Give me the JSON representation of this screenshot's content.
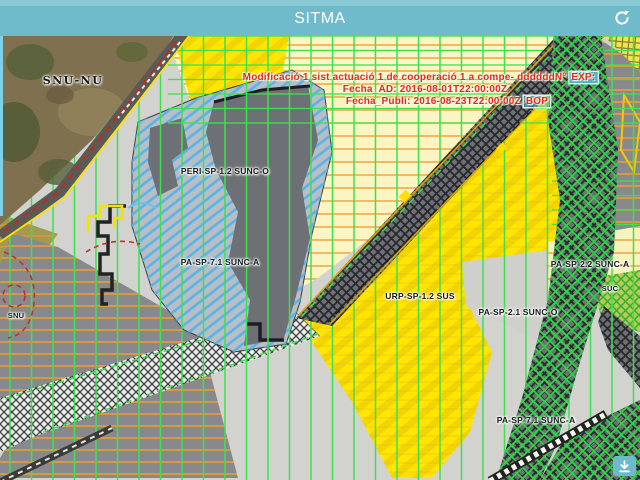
{
  "app": {
    "title": "SITMA",
    "header_color": "#6fbacb",
    "icons": {
      "refresh": "circular-refresh-arrow",
      "download": "download-arrow"
    }
  },
  "map": {
    "annotation": {
      "line1": "Modificació 1 sist actuació 1 de cooperació 1 a compe- ddddddNº",
      "line1_badge": "EXP:",
      "line2": "Fecha_AD: 2016-08-01T22:00:00Z",
      "line3": "Fecha_Publi: 2016-08-23T22:00:00Z",
      "line3_badge": "BOP",
      "text_color": "#dd2a1f",
      "badge_bg": "#4fb0c3"
    },
    "labels": [
      {
        "text": "SNU-NU"
      },
      {
        "text": "PERI-SP-1.2 SUNC-O"
      },
      {
        "text": "PA-SP-7.1 SUNC-A"
      },
      {
        "text": "URP-SP-1.2 SUS"
      },
      {
        "text": "PA-SP-2.1 SUNC-O"
      },
      {
        "text": "PA-SP-2.2 SUNC-A"
      },
      {
        "text": "SUC"
      },
      {
        "text": "PA-SP-7.1 SUNC-A"
      },
      {
        "text": "SNU"
      }
    ],
    "colors": {
      "grid_green": "#3ce24d",
      "zone_yellow": "#ffe600",
      "zone_pale_yellow": "#faf5c2",
      "zone_blue_hatch": "#57b4e8",
      "zone_light_gray": "#d2d2cf",
      "zone_dark_gray": "#6d7074",
      "line_orange": "#ec9f38"
    }
  }
}
